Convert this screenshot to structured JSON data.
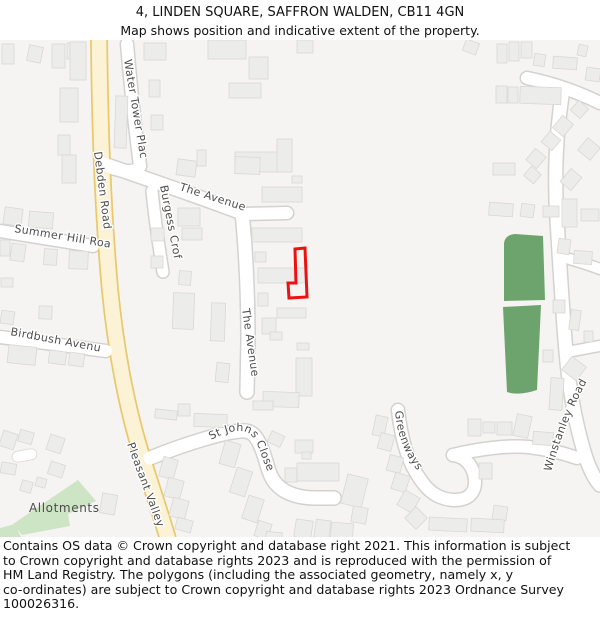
{
  "header": {
    "title": "4, LINDEN SQUARE, SAFFRON WALDEN, CB11 4GN",
    "subtitle": "Map shows position and indicative extent of the property."
  },
  "map": {
    "street_labels": {
      "water_tower_place": "Water Tower Place",
      "debden_road": "Debden Road",
      "burgess_croft": "Burgess Croft",
      "the_avenue_upper": "The Avenue",
      "the_avenue_lower": "The Avenue",
      "summer_hill_road": "Summer Hill Road",
      "birdbush_avenue": "Birdbush Avenue",
      "pleasant_valley": "Pleasant Valley",
      "st_johns_close": "St Johns Close",
      "greenways": "Greenways",
      "winstanley_road": "Winstanley Road",
      "allotments": "Allotments"
    },
    "property": {
      "address": "4, Linden Square, Saffron Walden, CB11 4GN",
      "outline_color": "#ee1111"
    },
    "colors": {
      "background": "#f5f4f2",
      "building_fill": "#ececea",
      "building_stroke": "#d9d8d6",
      "road_fill": "#ffffff",
      "road_casing": "#d3d2d0",
      "primary_road_fill": "#fcf3d7",
      "primary_road_casing": "#e9c96d",
      "greenspace_dark": "#6da46d",
      "greenspace_light": "#cde5c4",
      "label_color": "#4d4d4d",
      "property_outline": "#ee1111"
    }
  },
  "footer": {
    "lines": [
      "Contains OS data © Crown copyright and database right 2021. This information is subject",
      "to Crown copyright and database rights 2023 and is reproduced with the permission of",
      "HM Land Registry. The polygons (including the associated geometry, namely x, y",
      "co-ordinates) are subject to Crown copyright and database rights 2023 Ordnance Survey",
      "100026316."
    ]
  }
}
